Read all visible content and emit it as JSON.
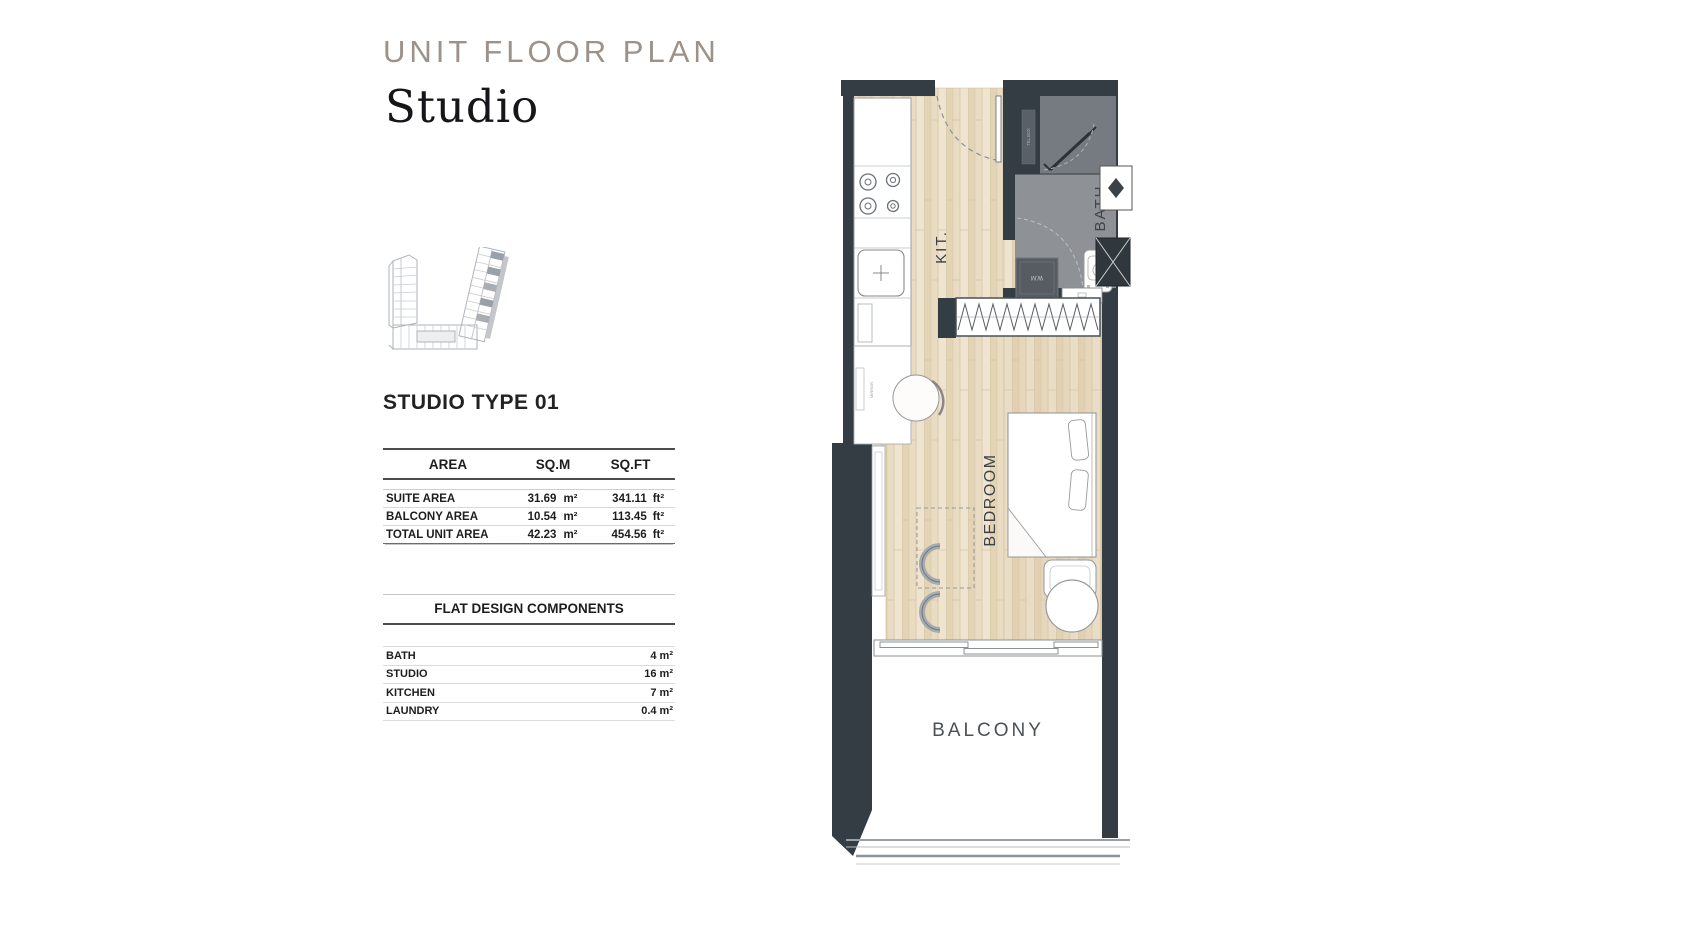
{
  "page": {
    "title": "UNIT FLOOR PLAN",
    "subtitle": "Studio",
    "type_heading": "STUDIO TYPE 01"
  },
  "area_table": {
    "col_area": "AREA",
    "col_sqm": "SQ.M",
    "col_sqft": "SQ.FT",
    "rows": [
      {
        "label": "SUITE  AREA",
        "sqm": "31.69",
        "sqm_unit": "m²",
        "sqft": "341.11",
        "sqft_unit": "ft²"
      },
      {
        "label": "BALCONY AREA",
        "sqm": "10.54",
        "sqm_unit": "m²",
        "sqft": "113.45",
        "sqft_unit": "ft²"
      },
      {
        "label": "TOTAL UNIT AREA",
        "sqm": "42.23",
        "sqm_unit": "m²",
        "sqft": "454.56",
        "sqft_unit": "ft²"
      }
    ]
  },
  "components": {
    "heading": "FLAT DESIGN COMPONENTS",
    "rows": [
      {
        "label": "BATH",
        "value": "4 m²"
      },
      {
        "label": "STUDIO",
        "value": "16 m²"
      },
      {
        "label": "KITCHEN",
        "value": "7 m²"
      },
      {
        "label": "LAUNDRY",
        "value": "0.4 m²"
      }
    ]
  },
  "plan_labels": {
    "kitchen": "KIT.",
    "bedroom": "BEDROOM",
    "bath": "BATH",
    "balcony": "BALCONY",
    "washer": "W.M",
    "telbox": "TEL.BOX",
    "mirror": "MIRROR"
  },
  "colors": {
    "wall": "#343d44",
    "wood_floor": "#e9dcc3",
    "bath_floor": "#8e9296",
    "shower_floor": "#757b80",
    "title_gray": "#9c9289"
  }
}
